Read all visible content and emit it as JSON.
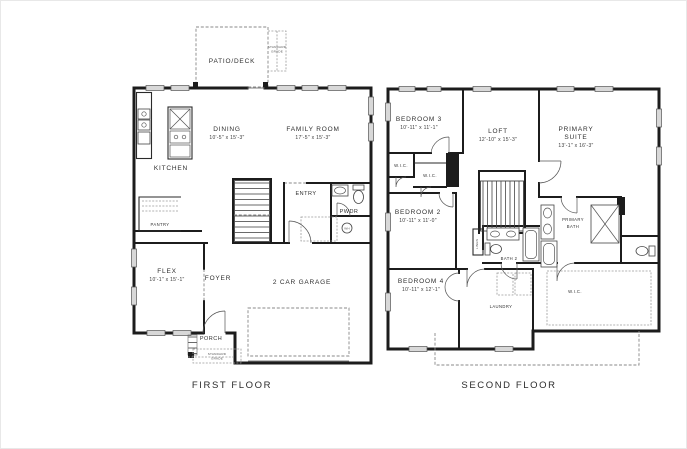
{
  "image": {
    "background": "#ffffff",
    "wall_color": "#1c1c1c",
    "window_fill": "#d8d8d8",
    "text_color": "#2f2f2f"
  },
  "first_floor": {
    "title": "FIRST FLOOR",
    "patio": {
      "label": "PATIO/DECK"
    },
    "patio_note": {
      "line1": "STANDARD",
      "line2": "GRADE"
    },
    "dining": {
      "label": "DINING",
      "dims": "10'-5\" x 15'-3\""
    },
    "family_room": {
      "label": "FAMILY ROOM",
      "dims": "17'-5\" x 15'-3\""
    },
    "kitchen": {
      "label": "KITCHEN"
    },
    "pantry": {
      "label": "PANTRY"
    },
    "entry": {
      "label": "ENTRY"
    },
    "powder": {
      "label": "PWDR"
    },
    "water_heater": {
      "label": "WH"
    },
    "flex": {
      "label": "FLEX",
      "dims": "10'-1\" x 15'-1\""
    },
    "foyer": {
      "label": "FOYER"
    },
    "garage": {
      "label": "2 CAR GARAGE"
    },
    "porch": {
      "label": "PORCH"
    },
    "porch_note": {
      "line1": "STANDARD",
      "line2": "GRADE"
    }
  },
  "second_floor": {
    "title": "SECOND FLOOR",
    "bedroom3": {
      "label": "BEDROOM 3",
      "dims": "10'-11\" x 11'-1\""
    },
    "loft": {
      "label": "LOFT",
      "dims": "12'-10\" x 15'-3\""
    },
    "primary_suite": {
      "line1": "PRIMARY",
      "line2": "SUITE",
      "dims": "13'-1\" x 16'-3\""
    },
    "wic_1": {
      "label": "W.I.C."
    },
    "wic_2": {
      "label": "W.I.C."
    },
    "bedroom2": {
      "label": "BEDROOM 2",
      "dims": "10'-11\" x 11'-0\""
    },
    "bath2": {
      "label": "BATH 2"
    },
    "linen": {
      "label": "LINEN"
    },
    "primary_bath": {
      "line1": "PRIMARY",
      "line2": "BATH"
    },
    "bedroom4": {
      "label": "BEDROOM 4",
      "dims": "10'-11\" x 12'-1\""
    },
    "laundry": {
      "label": "LAUNDRY"
    },
    "primary_wic": {
      "label": "W.I.C."
    }
  }
}
